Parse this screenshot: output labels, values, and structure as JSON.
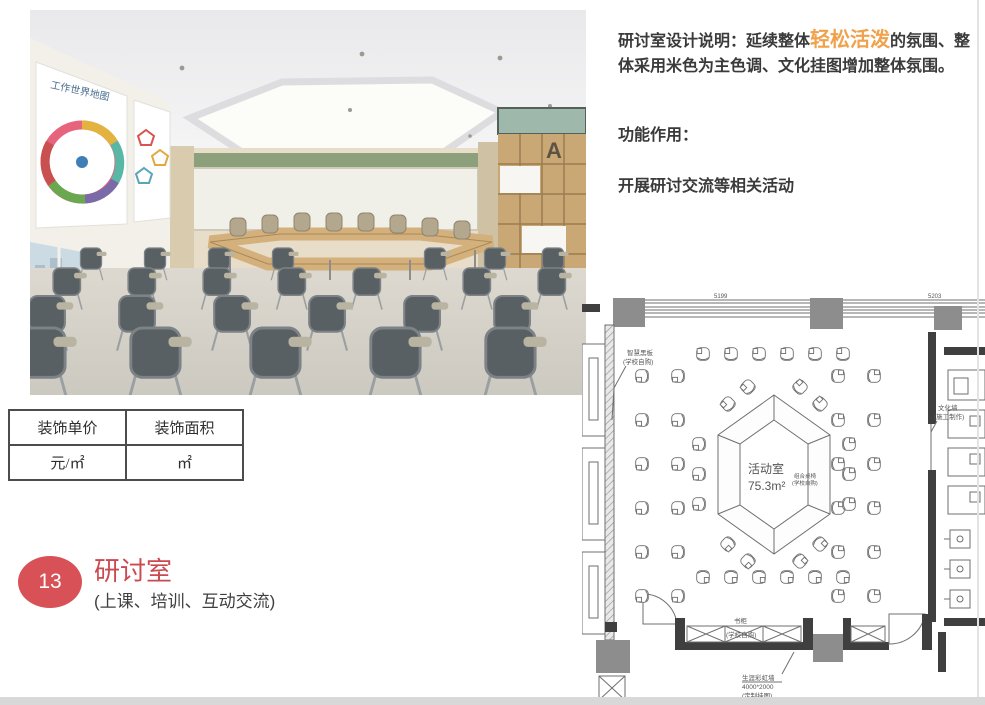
{
  "colors": {
    "accent_orange": "#f0a14c",
    "accent_red": "#d75157",
    "accent_red_dark": "#cb4a50",
    "plan_wall": "#3f3f3f",
    "photo_green_wall": "#8ba07b",
    "photo_wood": "#c9a876"
  },
  "description": {
    "intro_prefix": "研讨室设计说明：延续整体",
    "intro_highlight": "轻松活泼",
    "intro_suffix": "的氛围、整体采用米色为主色调、文化挂图增加整体氛围。",
    "function_label": "功能作用：",
    "function_text": "开展研讨交流等相关活动"
  },
  "info_table": {
    "columns": [
      {
        "header": "装饰单价",
        "value": "元/㎡"
      },
      {
        "header": "装饰面积",
        "value": "㎡"
      }
    ]
  },
  "section": {
    "number": "13",
    "title": "研讨室",
    "subtitle": "(上课、培训、互动交流)"
  },
  "photo": {
    "poster_title": "工作世界地图",
    "shelf_letter": "A"
  },
  "floorplan": {
    "dim_left": "5199",
    "dim_right": "5203",
    "room_name": "活动室",
    "room_area": "75.3m²",
    "label_blackboard_1": "智慧黑板",
    "label_blackboard_2": "(学校自购)",
    "label_culture_1": "文化墙",
    "label_culture_2": "(施工制作)",
    "label_combo_1": "组合桌椅",
    "label_combo_2": "(学校自购)",
    "label_bookcase_1": "书柜",
    "label_bookcase_2": "(学校自购)",
    "label_rainbow_1": "生涯彩虹墙",
    "label_rainbow_2": "4000*2000",
    "label_rainbow_3": "(定制挂图)"
  }
}
